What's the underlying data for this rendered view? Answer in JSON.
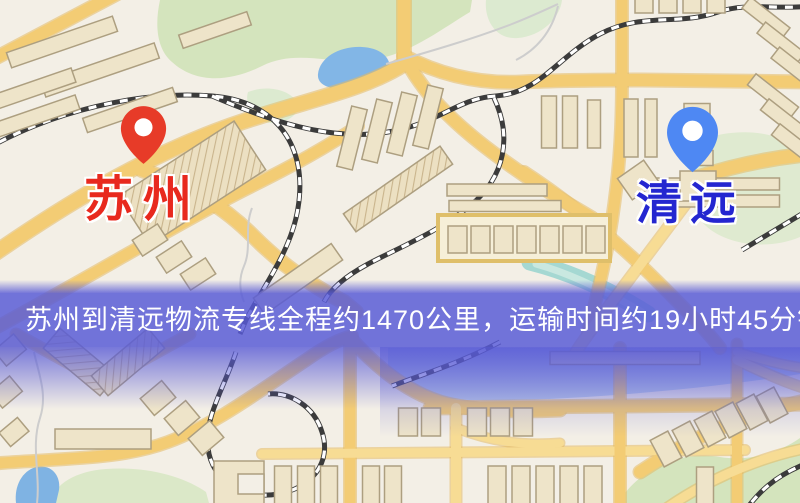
{
  "banner": {
    "text": "苏州到清远物流专线全程约1470公里，运输时间约19小时45分钟."
  },
  "markers": {
    "origin": {
      "label": "苏州"
    },
    "destination": {
      "label": "清远"
    }
  },
  "colors": {
    "banner-bg": "#585ad6",
    "banner-text": "#ffffff",
    "origin-label": "#e8291e",
    "destination-label": "#2426d0",
    "origin-pin": "#e73b28",
    "destination-pin": "#4e88f3"
  }
}
